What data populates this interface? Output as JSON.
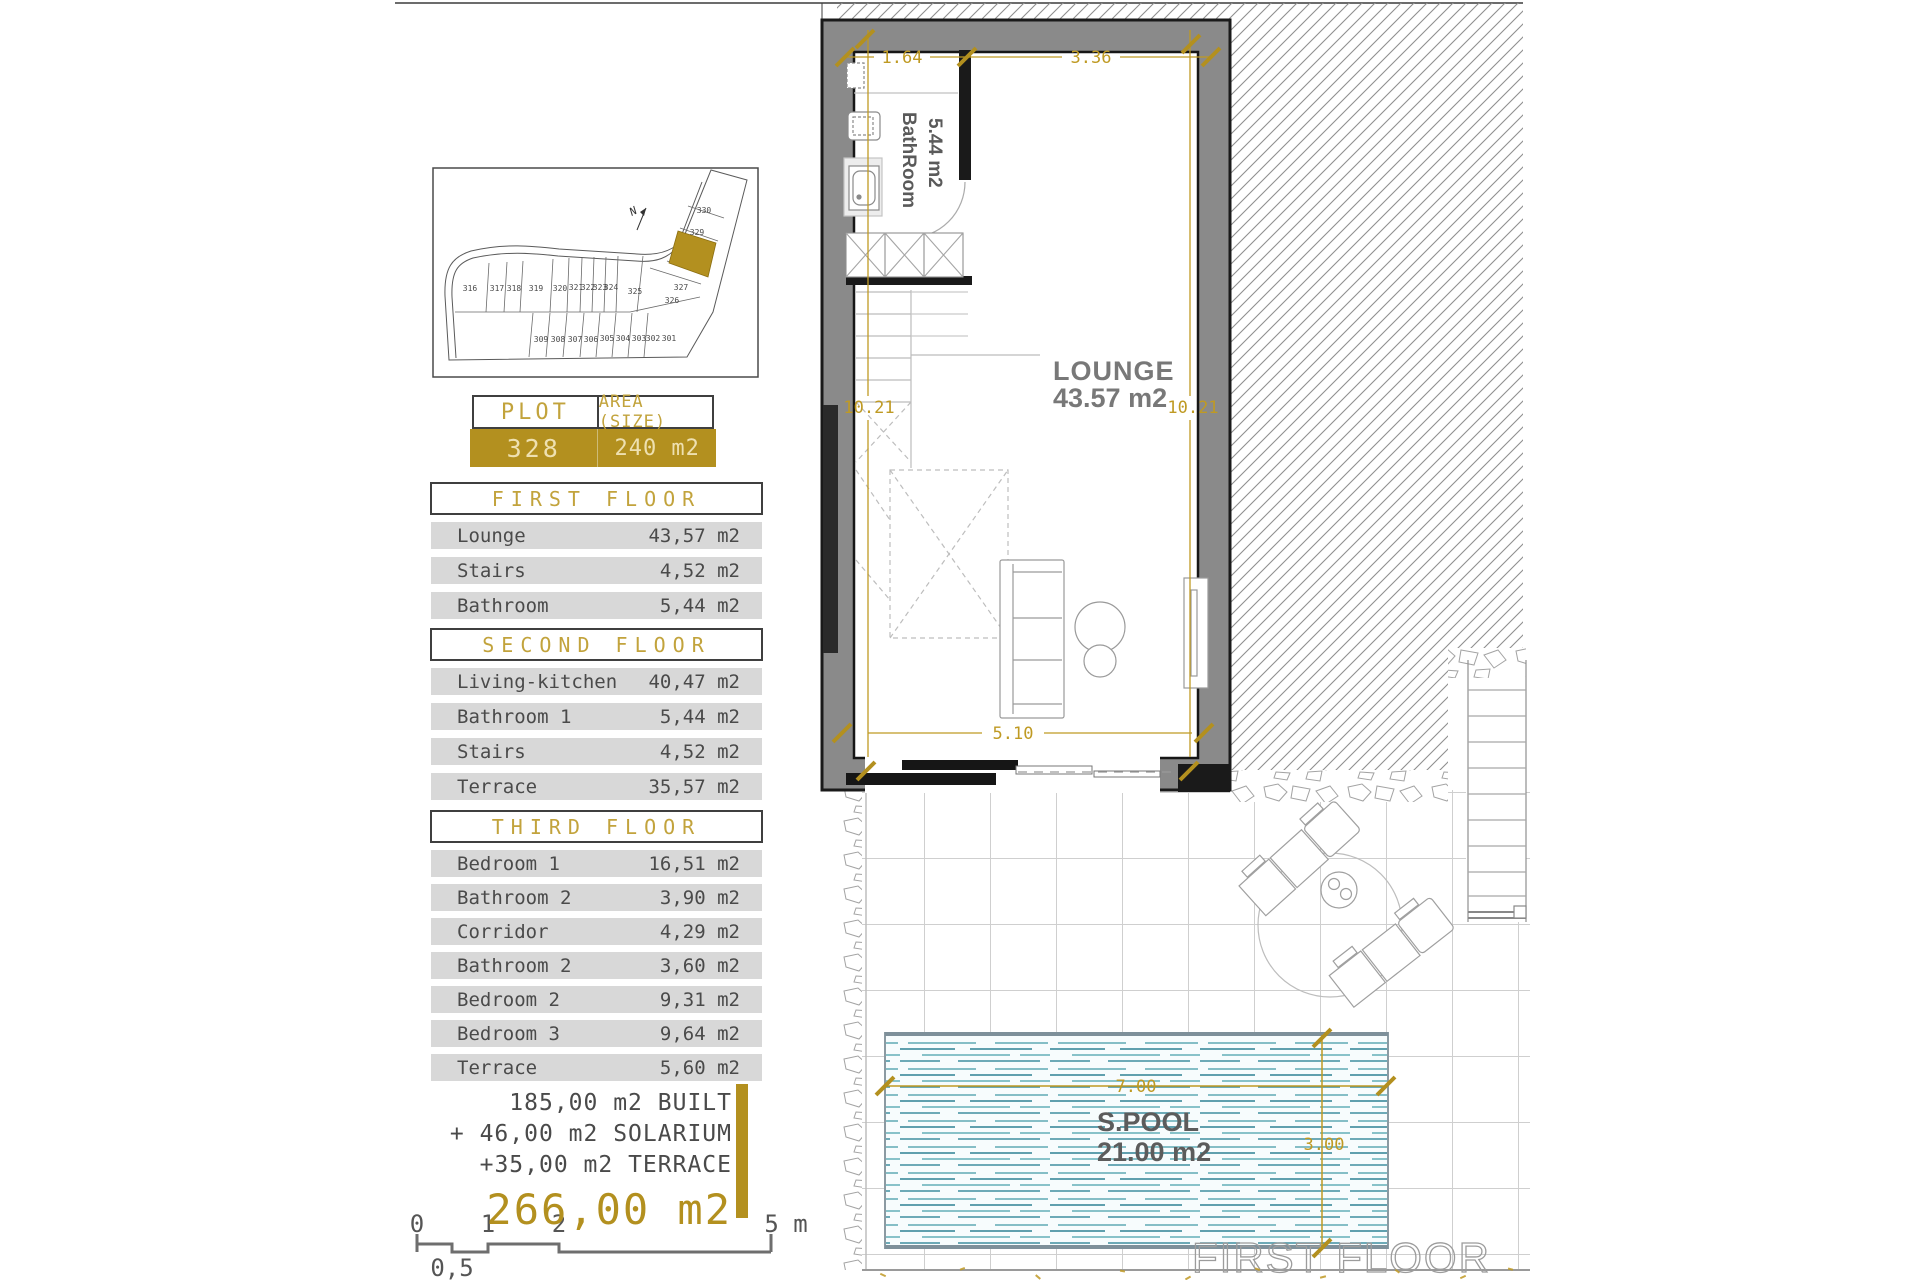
{
  "colors": {
    "accent_gold": "#b3901f",
    "wall_gray": "#8a8a8a",
    "row_gray": "#d8d8d8",
    "water_teal": "#3f8fa0",
    "text_gray": "#4a4a4a"
  },
  "site_plan": {
    "plots": [
      "316",
      "317",
      "318",
      "319",
      "320",
      "321",
      "322",
      "323",
      "324",
      "325",
      "326",
      "327",
      "329",
      "330",
      "309",
      "308",
      "307",
      "306",
      "305",
      "304",
      "303",
      "302",
      "301"
    ],
    "north_label": "N",
    "highlighted_plot": "328"
  },
  "plot_table": {
    "col1_header": "PLOT",
    "col2_header": "AREA (SIZE)",
    "plot_value": "328",
    "area_value": "240 m2"
  },
  "floors": [
    {
      "title": "FIRST FLOOR",
      "rows": [
        {
          "label": "Lounge",
          "value": "43,57 m2"
        },
        {
          "label": "Stairs",
          "value": "4,52 m2"
        },
        {
          "label": "Bathroom",
          "value": "5,44 m2"
        }
      ]
    },
    {
      "title": "SECOND FLOOR",
      "rows": [
        {
          "label": "Living-kitchen",
          "value": "40,47 m2"
        },
        {
          "label": "Bathroom 1",
          "value": "5,44 m2"
        },
        {
          "label": "Stairs",
          "value": "4,52 m2"
        },
        {
          "label": "Terrace",
          "value": "35,57 m2"
        }
      ]
    },
    {
      "title": "THIRD FLOOR",
      "rows": [
        {
          "label": "Bedroom 1",
          "value": "16,51 m2"
        },
        {
          "label": "Bathroom 2",
          "value": "3,90 m2"
        },
        {
          "label": "Corridor",
          "value": "4,29 m2"
        },
        {
          "label": "Bathroom 2",
          "value": "3,60 m2"
        },
        {
          "label": "Bedroom 2",
          "value": "9,31 m2"
        },
        {
          "label": "Bedroom 3",
          "value": "9,64 m2"
        },
        {
          "label": "Terrace",
          "value": "5,60 m2"
        }
      ]
    }
  ],
  "totals": {
    "line1": "185,00 m2 BUILT",
    "line2": "+ 46,00 m2 SOLARIUM",
    "line3": "+35,00 m2 TERRACE",
    "total": "266,00 m2"
  },
  "scale_bar": {
    "t0": "0",
    "t1": "1",
    "t2": "2",
    "t5": "5 m",
    "t05": "0,5"
  },
  "plan": {
    "lounge_name": "LOUNGE",
    "lounge_area": "43.57 m2",
    "bathroom_name": "BathRoom",
    "bathroom_area": "5.44 m2",
    "dim_top_left": "1.64",
    "dim_top_right": "3.36",
    "dim_left": "10.21",
    "dim_right": "10.21",
    "dim_bottom": "5.10"
  },
  "pool": {
    "name": "S.POOL",
    "area": "21.00 m2",
    "dim_width": "7.00",
    "dim_height": "3.00"
  },
  "watermark": "FIRST FLOOR"
}
